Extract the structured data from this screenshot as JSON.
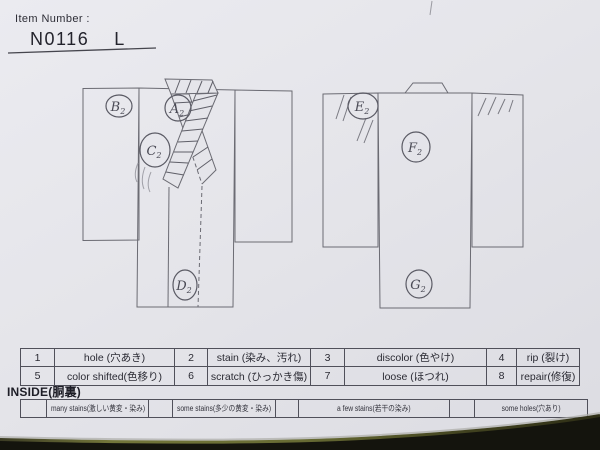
{
  "header": {
    "label": "Item Number :",
    "value": "N0116  L"
  },
  "marks": {
    "front": [
      {
        "letter": "B",
        "sub": "2"
      },
      {
        "letter": "A",
        "sub": "2"
      },
      {
        "letter": "C",
        "sub": "2"
      },
      {
        "letter": "D",
        "sub": "2"
      }
    ],
    "back": [
      {
        "letter": "E",
        "sub": "2"
      },
      {
        "letter": "F",
        "sub": "2"
      },
      {
        "letter": "G",
        "sub": "2"
      }
    ]
  },
  "legend": {
    "rows": [
      [
        {
          "num": "1",
          "label": "hole (穴あき)"
        },
        {
          "num": "2",
          "label": "stain (染み、汚れ)"
        },
        {
          "num": "3",
          "label": "discolor (色やけ)"
        },
        {
          "num": "4",
          "label": "rip (裂け)"
        }
      ],
      [
        {
          "num": "5",
          "label": "color shifted(色移り)"
        },
        {
          "num": "6",
          "label": "scratch (ひっかき傷)"
        },
        {
          "num": "7",
          "label": "loose (ほつれ)"
        },
        {
          "num": "8",
          "label": "repair(修復)"
        }
      ]
    ]
  },
  "inside": {
    "title": "INSIDE(胴裏)",
    "items": [
      "many stains(激しい黄変・染み)",
      "some stains(多少の黄変・染み)",
      "a few stains(若干の染み)",
      "some holes(穴あり)"
    ]
  },
  "colors": {
    "paper": "#e5e5ea",
    "ink_line": "#6b6b73",
    "table_border": "#50505a",
    "desk_olive": "#6b6e35",
    "desk_dark": "#14140d"
  }
}
